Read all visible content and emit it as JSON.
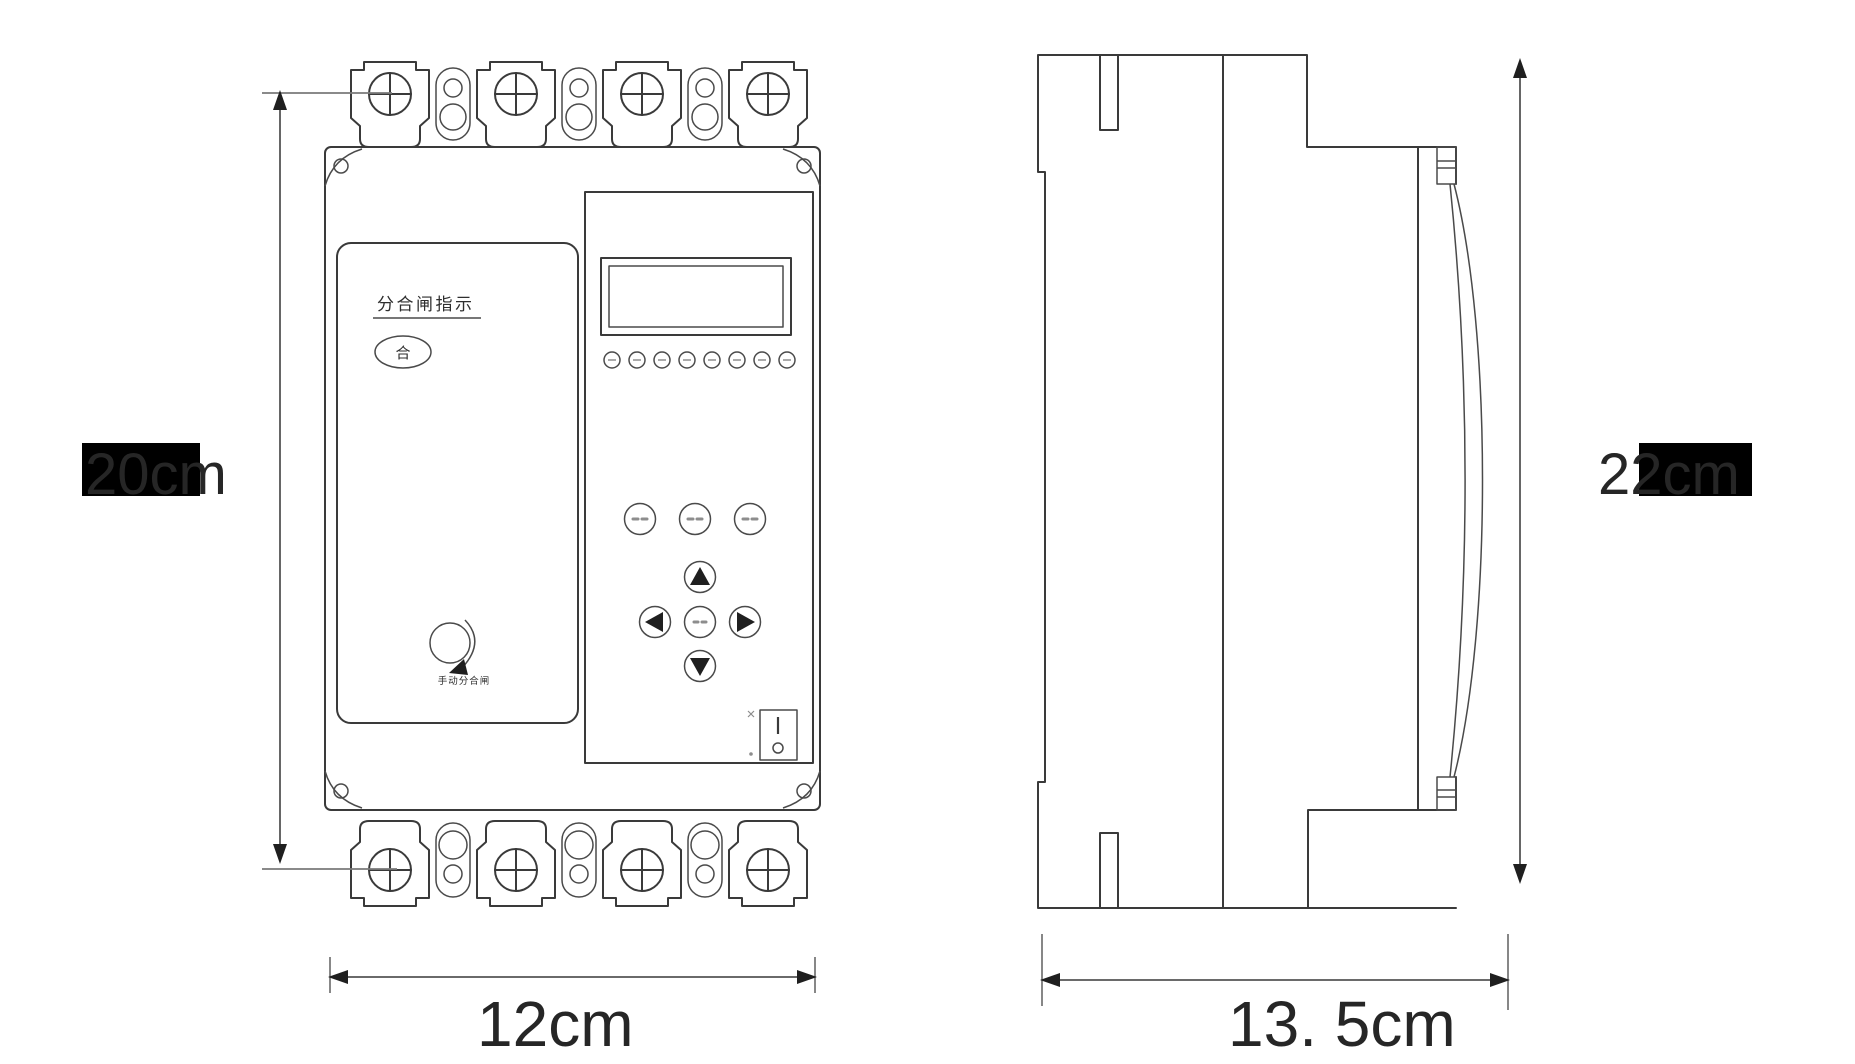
{
  "drawing": {
    "type": "technical-dimension-diagram",
    "subject": "molded-case circuit breaker, front view and side view",
    "dimensions": {
      "front_height": "20cm",
      "front_width": "12cm",
      "side_height": "22cm",
      "side_depth": "13. 5cm"
    },
    "front_view": {
      "indicator_panel_label": "分合闸指示",
      "close_state_label": "合",
      "manual_knob_label": "手动分合闸",
      "switch_on_mark": "I",
      "switch_off_mark": "O",
      "led_count": 8,
      "terminal_lug_count_top": 4,
      "terminal_lug_count_bottom": 4
    },
    "icons": {
      "screw_head": "circle-with-cross",
      "rotary_knob": "circle-with-clockwise-arrow",
      "dpad": [
        "up-triangle",
        "left-triangle",
        "center-round-button",
        "right-triangle",
        "down-triangle"
      ],
      "function_buttons": "three small round buttons with illegible two-character labels",
      "rocker_switch": "rectangle with I mark and O mark"
    },
    "colors": {
      "line": "#3a3a3a",
      "dimension_text": "#262626",
      "highlight_box": "#000000",
      "background": "#ffffff"
    }
  }
}
